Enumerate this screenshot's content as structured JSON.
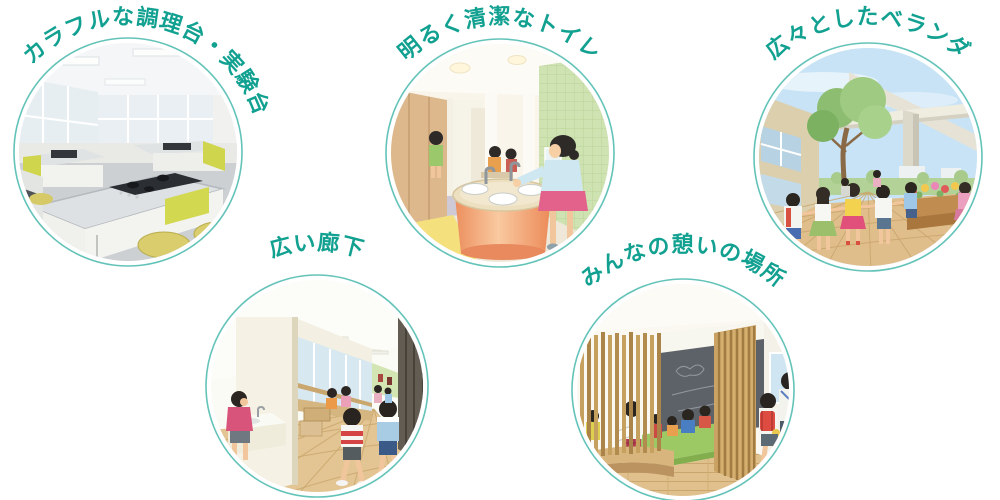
{
  "page": {
    "background": "#ffffff",
    "label_color": "#12a191",
    "ring_color": "#63c3b8"
  },
  "features": [
    {
      "label": "カラフルな調理台・実験台",
      "scene": "cooking-lab-classroom-photo"
    },
    {
      "label": "明るく清潔なトイレ",
      "scene": "bright-clean-toilet-illustration"
    },
    {
      "label": "広々としたベランダ",
      "scene": "spacious-veranda-illustration"
    },
    {
      "label": "広い廊下",
      "scene": "wide-corridor-illustration"
    },
    {
      "label": "みんなの憩いの場所",
      "scene": "community-lounge-illustration"
    }
  ]
}
